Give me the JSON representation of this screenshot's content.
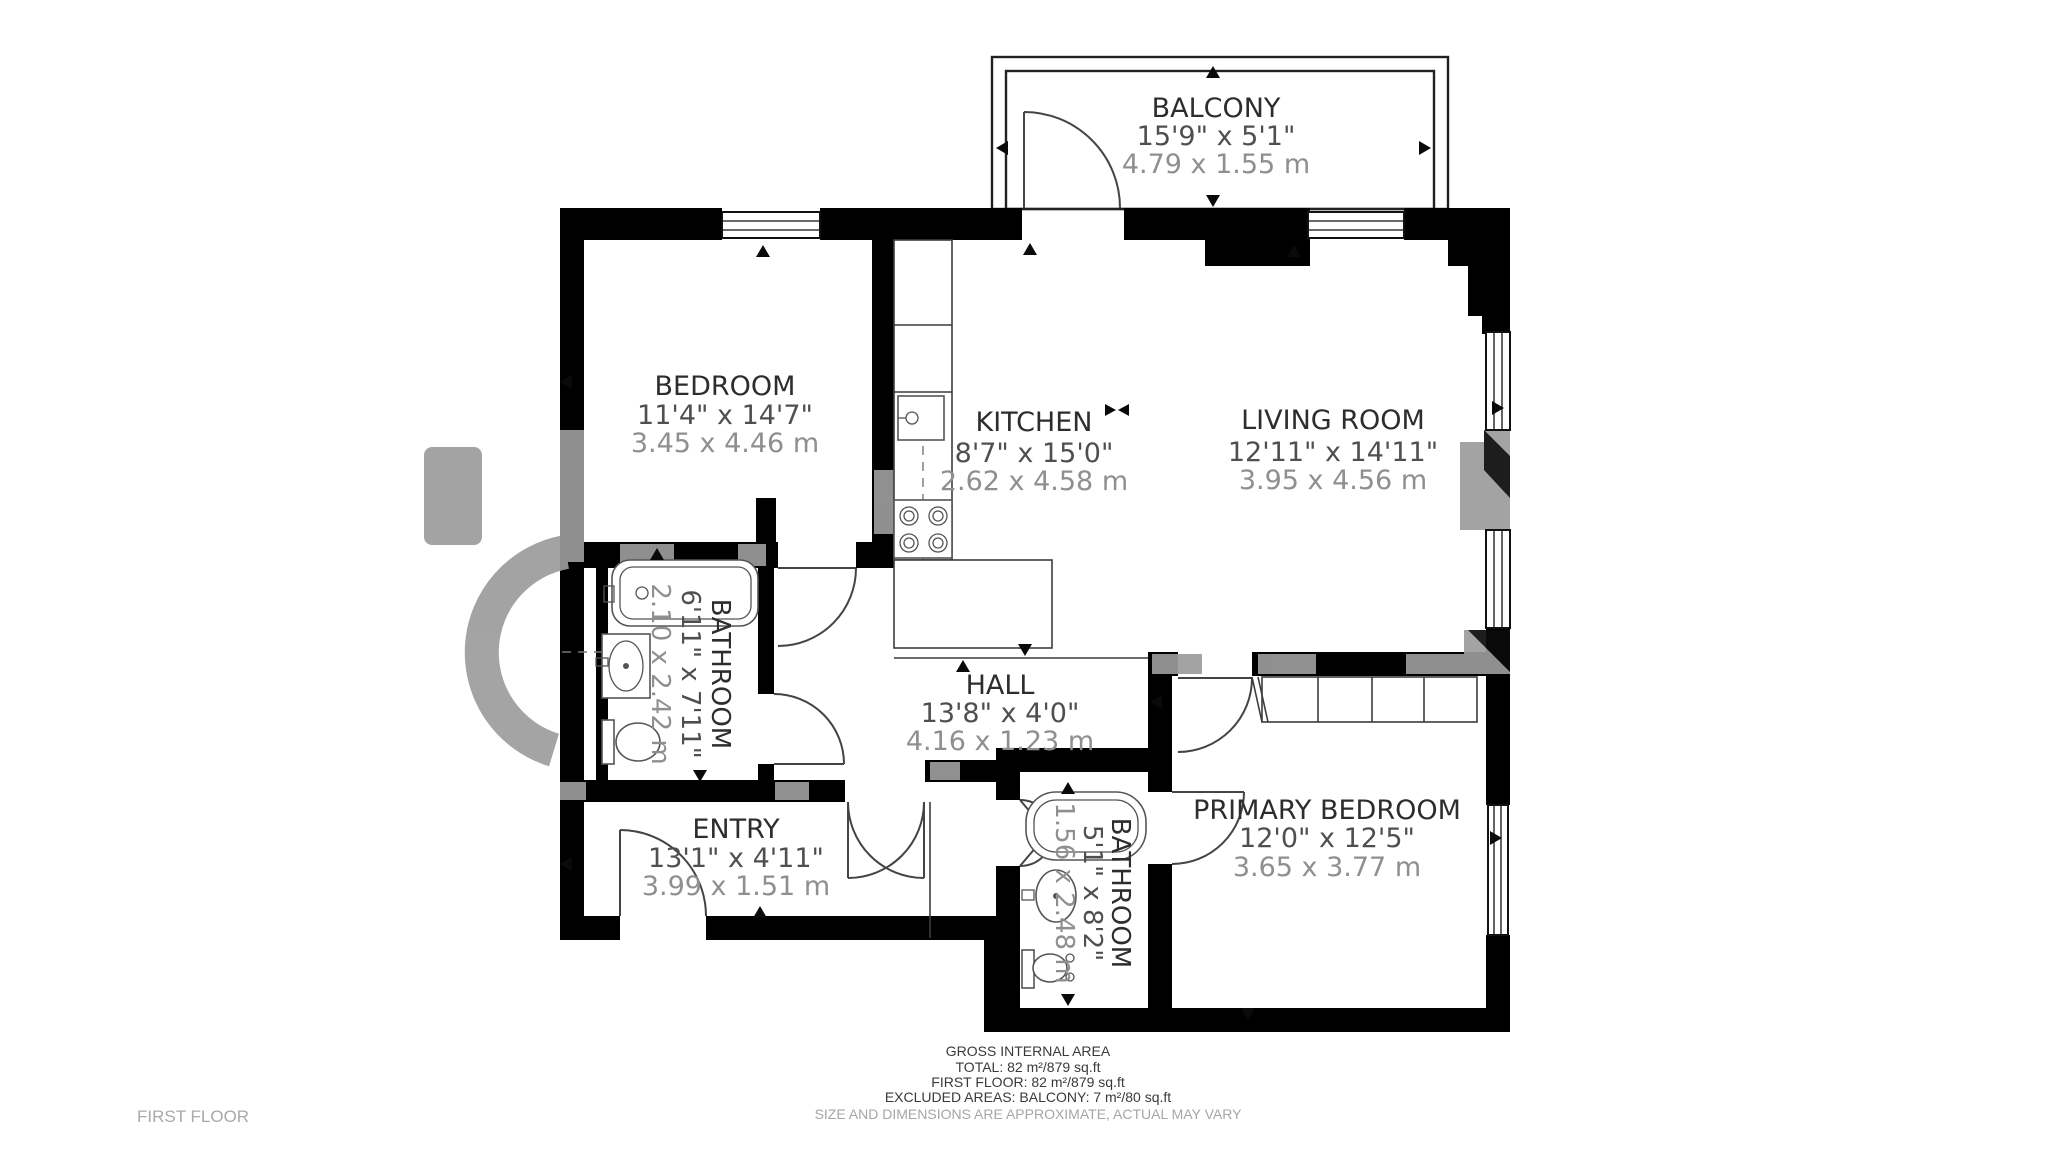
{
  "plan_title": "FIRST FLOOR",
  "rooms": [
    {
      "id": "balcony",
      "name": "BALCONY",
      "imperial": "15'9\" x 5'1\"",
      "metric": "4.79 x 1.55 m"
    },
    {
      "id": "bedroom",
      "name": "BEDROOM",
      "imperial": "11'4\" x 14'7\"",
      "metric": "3.45 x 4.46 m"
    },
    {
      "id": "kitchen",
      "name": "KITCHEN",
      "imperial": "8'7\" x 15'0\"",
      "metric": "2.62 x 4.58 m"
    },
    {
      "id": "living_room",
      "name": "LIVING ROOM",
      "imperial": "12'11\" x 14'11\"",
      "metric": "3.95 x 4.56 m"
    },
    {
      "id": "bathroom",
      "name": "BATHROOM",
      "imperial": "6'11\" x 7'11\"",
      "metric": "2.10 x 2.42 m"
    },
    {
      "id": "hall",
      "name": "HALL",
      "imperial": "13'8\" x 4'0\"",
      "metric": "4.16 x 1.23 m"
    },
    {
      "id": "entry",
      "name": "ENTRY",
      "imperial": "13'1\" x 4'11\"",
      "metric": "3.99 x 1.51 m"
    },
    {
      "id": "bathroom_2",
      "name": "BATHROOM",
      "imperial": "5'1\" x 8'2\"",
      "metric": "1.56 x 2.48 m"
    },
    {
      "id": "primary_bedroom",
      "name": "PRIMARY BEDROOM",
      "imperial": "12'0\" x 12'5\"",
      "metric": "3.65 x 3.77 m"
    }
  ],
  "footer": {
    "heading": "GROSS INTERNAL AREA",
    "total": "TOTAL: 82 m²/879 sq.ft",
    "first_floor": "FIRST FLOOR: 82 m²/879 sq.ft",
    "excluded": "EXCLUDED AREAS: BALCONY: 7 m²/80 sq.ft",
    "disclaimer": "SIZE AND DIMENSIONS ARE APPROXIMATE, ACTUAL MAY VARY"
  },
  "colors": {
    "wall": "#000000",
    "background": "#ffffff",
    "watermark": "#9c9c9c",
    "room_name": "#2d2d2d",
    "dimension_imperial": "#4f4f4f",
    "dimension_metric": "#8f8f8f",
    "footer_text": "#3a3a3a",
    "footer_muted": "#a6a6a6",
    "floor_label": "#a9a9a9"
  }
}
